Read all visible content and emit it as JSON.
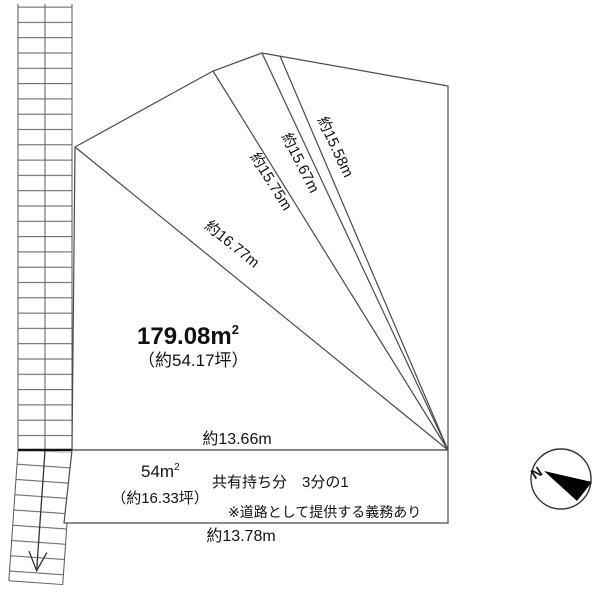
{
  "diagram_title": "land-plot-survey",
  "main_parcel": {
    "area_value": "179.08m",
    "area_superscript": "2",
    "area_tsubo": "（約54.17坪）",
    "dim_left_diagonal": "約16.77m",
    "dim_diagonal_2": "約15.75m",
    "dim_diagonal_3": "約15.67m",
    "dim_diagonal_4": "約15.58m",
    "dim_bottom": "約13.66m"
  },
  "road_parcel": {
    "area_value": "54m",
    "area_superscript": "2",
    "area_tsubo": "（約16.33坪）",
    "ownership": "共有持ち分　3分の1",
    "note": "※道路として提供する義務あり",
    "dim_bottom": "約13.78m"
  },
  "compass": {
    "north": "N"
  },
  "colors": {
    "line": "#4a4a4a",
    "text": "#111111",
    "needle": "#000000"
  }
}
